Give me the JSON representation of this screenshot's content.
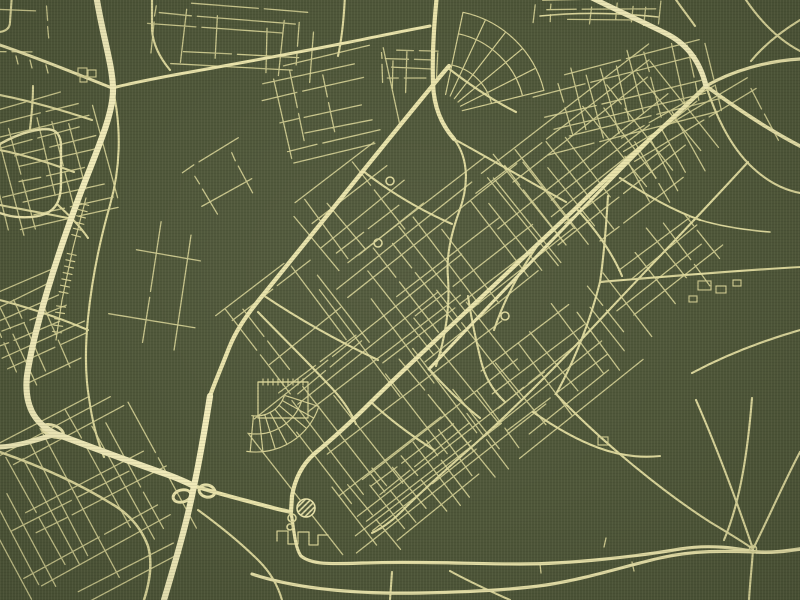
{
  "map": {
    "canvas": {
      "width": 800,
      "height": 600
    },
    "style_name": "green-gold-city-map",
    "colors": {
      "background": "#4e5639",
      "road_minor": "#d3ce92",
      "road_medium": "#ddd89c",
      "road_major": "#e9e3aa",
      "road_highway": "#f2ecba",
      "texture_light": "rgba(238,234,196,0.05)",
      "texture_dark": "rgba(18,22,8,0.08)"
    },
    "widths": {
      "highway": 6.2,
      "major": 4.2,
      "medium": 2.1,
      "minor": 1.3
    },
    "roads": {
      "highway": [
        "M96,-6 C102,34 113,66 113,90 C113,116 96,152 79,197 C57,256 34,328 27,376 C24,404 33,423 56,434 C78,442 120,458 160,472 C175,477 186,482 194,486",
        "M210,396 C205,428 200,458 194,486 C187,522 177,556 164,600",
        {
          "d": "M0,447 C18,446 36,440 56,434",
          "w": 5
        },
        {
          "d": "M584,-6 C610,7 641,21 665,33 C686,43 700,61 706,86",
          "w": 5.2
        }
      ],
      "major": [
        "M706,86 C662,130 616,168 576,208 C540,242 505,275 470,308 C436,340 401,372 371,402 C351,422 330,441 314,454 C303,464 295,478 292,496 L291,512",
        "M449,66 C430,88 401,124 363,171 C331,211 296,254 263,295 C244,318 235,333 229,348 C222,366 215,382 210,396",
        {
          "d": "M706,86 C736,108 769,130 800,146",
          "w": 3.6
        },
        {
          "d": "M706,86 C732,71 766,61 800,59",
          "w": 3.2
        },
        "M437,-6 C434,24 432,54 433,84 C434,107 441,124 454,139",
        {
          "d": "M648,142 C602,188 556,236 511,283 C481,314 453,344 429,369",
          "w": 3
        },
        {
          "d": "M0,45 C35,57 75,73 112,88 C132,83 162,77 196,71 C240,63 300,52 350,42 C380,36 408,30 430,26",
          "w": 3
        },
        {
          "d": "M194,486 C230,497 255,503 270,507 C280,510 287,511 291,512",
          "w": 4
        },
        {
          "d": "M291,512 C294,530 295,548 301,556 C312,565 332,564 362,563 C420,561 470,564 520,564 C572,564 640,556 680,549 C710,544 735,548 757,552",
          "w": 3.2
        },
        {
          "d": "M757,552 C772,553 786,551 800,549",
          "w": 3.6
        },
        {
          "d": "M252,574 C300,590 360,594 420,593 C470,592 512,590 546,585 C590,578 625,566 660,558 C695,550 725,551 757,552",
          "w": 3.2
        },
        {
          "d": "M0,144 C14,136 30,130 45,129 C56,129 61,134 61,147 L61,183 C61,199 57,209 45,214 C32,219 12,218 0,213",
          "w": 2.4
        }
      ],
      "medium": [
        "M748,162 C706,208 658,258 611,308 C561,362 511,412 466,452 C441,474 421,492 401,512 C390,523 380,529 372,533",
        "M113,90 C122,130 120,170 110,205 C100,240 92,278 88,318 C85,348 85,374 89,398 C92,420 97,440 104,457",
        "M152,-6 L152,30 C153,44 160,58 170,70",
        "M345,-6 C344,18 342,38 338,56",
        "M706,86 C716,116 731,148 753,168 C768,182 784,190 800,193",
        "M742,-6 C760,22 779,40 800,51",
        "M800,20 C782,31 764,45 751,61",
        "M672,-6 C680,6 688,16 695,26",
        "M600,282 C660,277 730,271 800,267",
        "M608,196 C606,228 604,256 600,282",
        "M600,282 C591,318 576,358 556,394",
        "M556,394 C600,440 660,490 710,522 C730,534 742,541 753,549",
        "M753,549 C770,515 786,478 800,452",
        "M753,549 C752,566 750,582 749,600",
        "M696,400 C720,455 738,505 753,549",
        "M533,412 C556,428 577,440 599,448 C621,456 641,458 660,456",
        "M752,398 C748,448 741,500 724,540",
        "M198,510 C220,526 241,543 259,561 C271,573 278,586 282,600",
        "M450,571 C470,582 492,592 510,600",
        {
          "d": "M0,452 C40,466 80,484 112,504 C131,515 142,530 148,546 C152,560 151,578 144,600",
          "w": 2.5
        },
        "M0,205 C25,210 48,214 68,218",
        "M0,300 C30,308 60,318 88,330",
        "M0,150 C25,155 50,163 74,172",
        "M0,95 C30,101 62,110 92,120",
        "M800,330 C762,341 724,356 692,373",
        {
          "d": "M540,16 C580,12 620,13 658,17",
          "w": 1.6
        },
        "M454,139 C470,160 468,188 459,212 C451,234 446,257 448,278 C450,305 446,336 436,366",
        "M468,296 C472,324 477,344 481,361 C485,377 493,391 505,402",
        "M258,312 C280,335 304,358 326,382 C340,396 350,410 356,424",
        "M12,-6 L10,22 C10,28 6,31 0,32",
        "M448,68 C470,85 492,100 516,112",
        "M363,171 C390,192 420,210 452,224",
        "M263,295 C300,320 340,342 378,360",
        "M576,208 C596,230 612,252 622,276",
        "M540,242 C520,270 504,300 494,330",
        "M429,369 C446,388 462,404 480,418",
        "M371,402 C390,420 412,436 434,450",
        "M620,178 C648,196 672,210 700,220",
        {
          "d": "M700,220 C720,226 745,230 770,232",
          "w": 1.6
        },
        "M454,139 C492,160 530,182 566,202",
        "M58,205 C70,216 80,226 88,238",
        "M30,129 C32,112 33,98 33,86",
        "M392,572 L390,600"
      ],
      "minor": [
        "M277,541 L277,531 L288,531 L288,544 L298,544 L298,532 L309,532 L309,545 L318,545 L318,535 L328,535",
        "M258,382 L308,382 L308,418 L258,418 Z",
        "M16,56 L18,64 M30,60 L32,68 M46,65 L48,73",
        "M604,547 L606,538 M632,562 L634,571 M540,564 L541,573"
      ]
    },
    "grids": [
      {
        "cx": 598,
        "cy": 166,
        "w": 240,
        "h": 130,
        "a": -38,
        "sA": 13,
        "sB": 16,
        "drop": 0.26,
        "seed": 11
      },
      {
        "cx": 462,
        "cy": 270,
        "w": 250,
        "h": 150,
        "a": -38,
        "sA": 14,
        "sB": 17,
        "drop": 0.26,
        "seed": 23
      },
      {
        "cx": 408,
        "cy": 408,
        "w": 280,
        "h": 170,
        "a": -38,
        "sA": 14,
        "sB": 18,
        "drop": 0.3,
        "seed": 37
      },
      {
        "cx": 664,
        "cy": 262,
        "w": 150,
        "h": 110,
        "a": -38,
        "sA": 16,
        "sB": 20,
        "drop": 0.38,
        "seed": 41
      },
      {
        "cx": 628,
        "cy": 92,
        "w": 190,
        "h": 85,
        "a": -14,
        "sA": 12,
        "sB": 15,
        "drop": 0.32,
        "seed": 53
      },
      {
        "cx": 50,
        "cy": 165,
        "w": 115,
        "h": 130,
        "a": -14,
        "sA": 12,
        "sB": 14,
        "drop": 0.3,
        "seed": 61
      },
      {
        "cx": 38,
        "cy": 330,
        "w": 100,
        "h": 100,
        "a": -24,
        "sA": 12,
        "sB": 13,
        "drop": 0.36,
        "seed": 71
      },
      {
        "cx": 82,
        "cy": 502,
        "w": 185,
        "h": 180,
        "a": -28,
        "sA": 12,
        "sB": 15,
        "drop": 0.3,
        "seed": 83
      },
      {
        "cx": 160,
        "cy": 300,
        "w": 170,
        "h": 110,
        "a": -82,
        "sA": 15,
        "sB": 22,
        "drop": 0.42,
        "seed": 97
      },
      {
        "cx": 232,
        "cy": 42,
        "w": 190,
        "h": 70,
        "a": 4,
        "sA": 12,
        "sB": 16,
        "drop": 0.36,
        "seed": 101
      },
      {
        "cx": 700,
        "cy": 140,
        "w": 150,
        "h": 80,
        "a": -30,
        "sA": 13,
        "sB": 16,
        "drop": 0.42,
        "seed": 113
      },
      {
        "cx": 330,
        "cy": 108,
        "w": 130,
        "h": 100,
        "a": -12,
        "sA": 14,
        "sB": 16,
        "drop": 0.45,
        "seed": 127
      },
      {
        "cx": 548,
        "cy": 372,
        "w": 170,
        "h": 110,
        "a": -38,
        "sA": 13,
        "sB": 16,
        "drop": 0.3,
        "seed": 131
      },
      {
        "cx": 15,
        "cy": 25,
        "w": 60,
        "h": 50,
        "a": 0,
        "sA": 10,
        "sB": 12,
        "drop": 0.5,
        "seed": 139
      },
      {
        "cx": 412,
        "cy": 72,
        "w": 58,
        "h": 42,
        "a": 0,
        "sA": 9,
        "sB": 11,
        "drop": 0.3,
        "seed": 149
      },
      {
        "cx": 600,
        "cy": 14,
        "w": 130,
        "h": 26,
        "a": 0,
        "sA": 9,
        "sB": 14,
        "drop": 0.42,
        "seed": 151
      },
      {
        "cx": 228,
        "cy": 182,
        "w": 85,
        "h": 60,
        "a": -30,
        "sA": 13,
        "sB": 15,
        "drop": 0.45,
        "seed": 157
      },
      {
        "cx": 420,
        "cy": 478,
        "w": 150,
        "h": 95,
        "a": -38,
        "sA": 12,
        "sB": 15,
        "drop": 0.3,
        "seed": 163
      },
      {
        "cx": 296,
        "cy": 330,
        "w": 120,
        "h": 120,
        "a": -38,
        "sA": 14,
        "sB": 16,
        "drop": 0.34,
        "seed": 167
      },
      {
        "cx": 360,
        "cy": 210,
        "w": 110,
        "h": 90,
        "a": -38,
        "sA": 13,
        "sB": 16,
        "drop": 0.4,
        "seed": 173
      }
    ],
    "ladders": [
      {
        "pts": [
          [
            86,
            198
          ],
          [
            73,
            248
          ],
          [
            62,
            300
          ],
          [
            56,
            340
          ]
        ],
        "step": 6.5,
        "len": 9
      },
      {
        "pts": [
          [
            258,
            382
          ],
          [
            308,
            382
          ]
        ],
        "step": 5,
        "len": 6
      }
    ],
    "fans": [
      {
        "cx": 256,
        "cy": 386,
        "a0": 18,
        "a1": 98,
        "step": 11,
        "r0": 30,
        "r1": 66,
        "arcs": [
          30,
          48,
          66
        ]
      },
      {
        "cx": 441,
        "cy": 116,
        "a0": -78,
        "a1": -14,
        "step": 12.8,
        "r0": 22,
        "r1": 106,
        "arcs": [
          52,
          84,
          106
        ]
      }
    ],
    "landmarks": {
      "ramp_loops": [
        {
          "cx": 53,
          "cy": 431,
          "rx": 11,
          "ry": 5.5,
          "rot": 22
        },
        {
          "cx": 182,
          "cy": 496,
          "rx": 9,
          "ry": 6,
          "rot": -15
        },
        {
          "cx": 207,
          "cy": 491,
          "rx": 8,
          "ry": 6,
          "rot": 15
        }
      ],
      "circles": [
        {
          "cx": 292,
          "cy": 518,
          "r": 4
        },
        {
          "cx": 290,
          "cy": 527,
          "r": 3
        },
        {
          "cx": 505,
          "cy": 316,
          "r": 4
        },
        {
          "cx": 390,
          "cy": 181,
          "r": 4
        },
        {
          "cx": 378,
          "cy": 243,
          "r": 4
        },
        {
          "cx": 753,
          "cy": 549,
          "r": 3.5
        }
      ],
      "hatched_circle": {
        "cx": 306,
        "cy": 508,
        "r": 9
      },
      "buildings": [
        {
          "x": 78,
          "y": 68,
          "w": 9,
          "h": 8
        },
        {
          "x": 88,
          "y": 70,
          "w": 8,
          "h": 7
        },
        {
          "x": 80,
          "y": 77,
          "w": 7,
          "h": 5
        },
        {
          "x": 698,
          "y": 281,
          "w": 13,
          "h": 9
        },
        {
          "x": 716,
          "y": 286,
          "w": 10,
          "h": 7
        },
        {
          "x": 733,
          "y": 280,
          "w": 8,
          "h": 6
        },
        {
          "x": 689,
          "y": 296,
          "w": 8,
          "h": 6
        },
        {
          "x": 598,
          "y": 437,
          "w": 10,
          "h": 8
        }
      ]
    }
  }
}
